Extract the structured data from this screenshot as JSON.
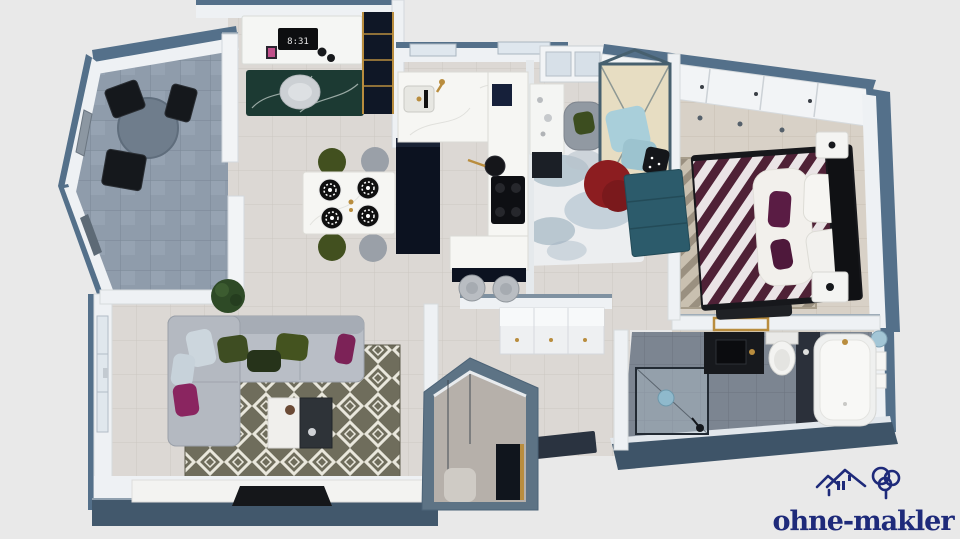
{
  "scene": {
    "description": "3D top-down floor plan rendering of a furnished apartment",
    "background_color": "#e9e9e9"
  },
  "watermark": {
    "text": "ohne-makler",
    "color": "#1e2a7a",
    "icon": "house-and-tree-logo-icon"
  },
  "clock": {
    "time": "8:31",
    "location": "monitor on office desk"
  },
  "palette": {
    "wall_cut_blue": "#54708a",
    "wall_white": "#eef1f4",
    "floor_tile": "#dcd8d4",
    "balcony_tile": "#8f9cab",
    "bathroom_tile": "#7c8591",
    "cabinet_navy": "#0c1220",
    "marble": "#f6f6f3",
    "brass": "#b98d3e",
    "sofa_grey": "#b9bec6",
    "cushion_green": "#3e4d22",
    "cushion_magenta": "#8a2560",
    "armchair_red": "#8c1d20",
    "sideboard_teal": "#2c5b6b",
    "bedding_plum": "#4f2136",
    "rug_olive": "#6f6d5c",
    "logo_navy": "#1e2a7a"
  },
  "rooms": [
    {
      "name": "balcony",
      "furniture": [
        "round bistro table",
        "three black chairs",
        "potted plant"
      ]
    },
    {
      "name": "home-office",
      "furniture": [
        "white desk",
        "monitor showing 8:31",
        "desk chair",
        "green marble rug",
        "navy shelf with brass frame"
      ]
    },
    {
      "name": "dining-area",
      "furniture": [
        "white marble dining table",
        "two green chairs",
        "two grey chairs",
        "four patterned place settings"
      ]
    },
    {
      "name": "kitchen",
      "furniture": [
        "U-shaped white marble counter",
        "navy cabinets",
        "sink with brass tap",
        "hob with pan",
        "two bar stools"
      ]
    },
    {
      "name": "hallway-nook",
      "furniture": [
        "white console table",
        "grey armchair with green cushion",
        "red armchair",
        "canopy daybed with blue cushions",
        "petrol-blue sideboard",
        "abstract blue-white rug",
        "white shoe cabinet with brass knobs",
        "dark doormat"
      ]
    },
    {
      "name": "bedroom",
      "furniture": [
        "white wardrobe wall",
        "double bed with plum striped bedding",
        "white fur throw",
        "two nightstands",
        "foot bench",
        "taupe geometric rug"
      ]
    },
    {
      "name": "bathroom",
      "furniture": [
        "walk-in shower",
        "black vanity with basin",
        "toilet",
        "bathtub",
        "brass towel shelf",
        "round blue mirror"
      ]
    },
    {
      "name": "living-room",
      "furniture": [
        "grey corner sofa",
        "green and magenta cushions",
        "olive diamond-pattern rug",
        "two-tone coffee table",
        "white TV sideboard",
        "flat TV",
        "potted plant"
      ]
    },
    {
      "name": "entrance",
      "furniture": [
        "dark front door with brass trim",
        "glass partition",
        "doormat"
      ]
    }
  ]
}
